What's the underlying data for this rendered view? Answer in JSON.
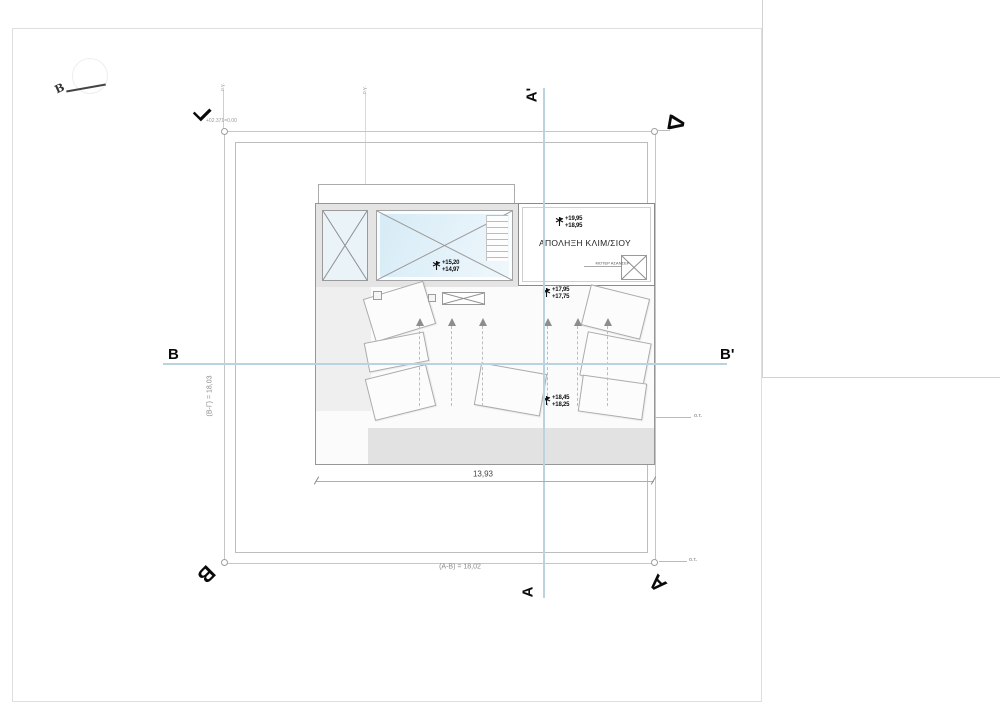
{
  "compass": {
    "letter": "B"
  },
  "survey": {
    "note": "+02.371=0.00"
  },
  "corners": {
    "gamma": "Γ",
    "delta": "Δ",
    "beta": "Β",
    "alpha": "Α"
  },
  "sections": {
    "a_top": "Α'",
    "a_bottom": "Α",
    "b_left": "Β",
    "b_right": "Β'"
  },
  "dims": {
    "inner": "13,93",
    "bottom": "(Α-Β) = 18,02",
    "left": "(Β-Γ) = 18,03"
  },
  "labels": {
    "ot_right": "ο.τ.",
    "ot_bottom": "ο.τ.",
    "og_1": "ο.γ.",
    "og_2": "ο.γ."
  },
  "room": {
    "name": "ΑΠΟΛΗΞΗ ΚΛΙΜ/ΣΙΟΥ",
    "motor": "ΜΟΤΕΡ ΑΣΑΝΣΕΡ"
  },
  "levels": {
    "bulkhead": {
      "upper": "+19,95",
      "lower": "+18,95"
    },
    "pool": {
      "upper": "+15,20",
      "lower": "+14,97"
    },
    "roof_upper": {
      "upper": "+17,95",
      "lower": "+17,75"
    },
    "roof_lower": {
      "upper": "+18,45",
      "lower": "+18,25"
    }
  },
  "colors": {
    "section_line": "#b9d4e0",
    "pool_fill": "#d5ebf6",
    "panel_border": "#ababab"
  }
}
